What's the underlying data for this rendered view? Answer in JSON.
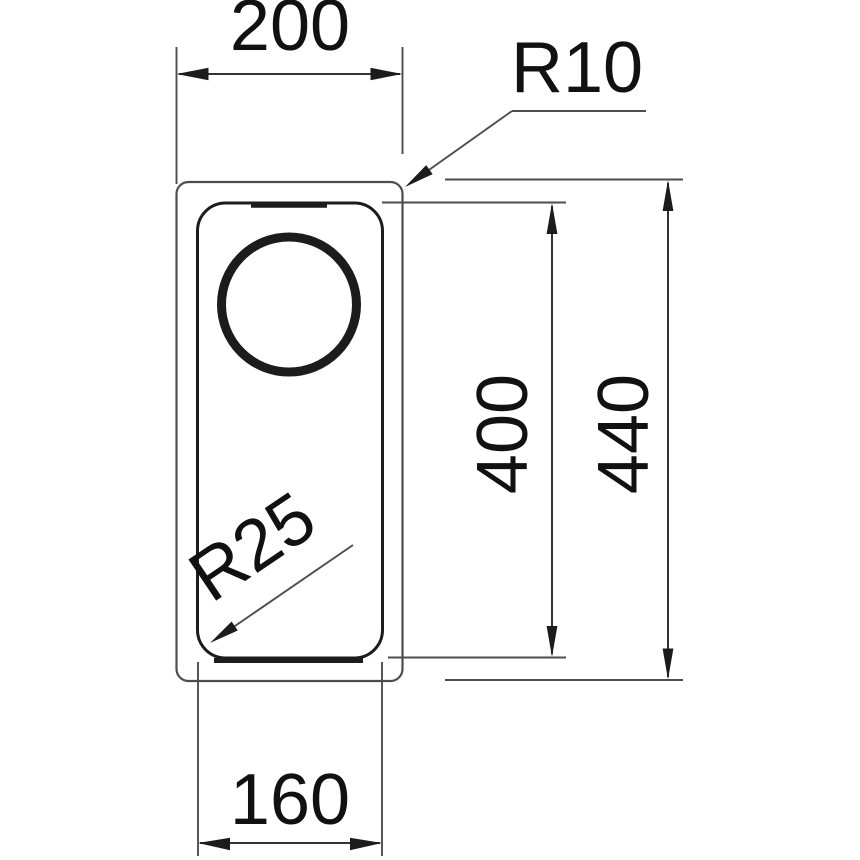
{
  "drawing": {
    "labels": {
      "outer_width": "200",
      "outer_corner_radius": "R10",
      "bowl_length": "400",
      "outer_length": "440",
      "bowl_corner_radius": "R25",
      "bowl_width": "160"
    },
    "colors": {
      "background": "#ffffff",
      "line_thin": "#4d4d4d",
      "line_dim": "#333333",
      "ink": "#1c1c1c"
    }
  }
}
